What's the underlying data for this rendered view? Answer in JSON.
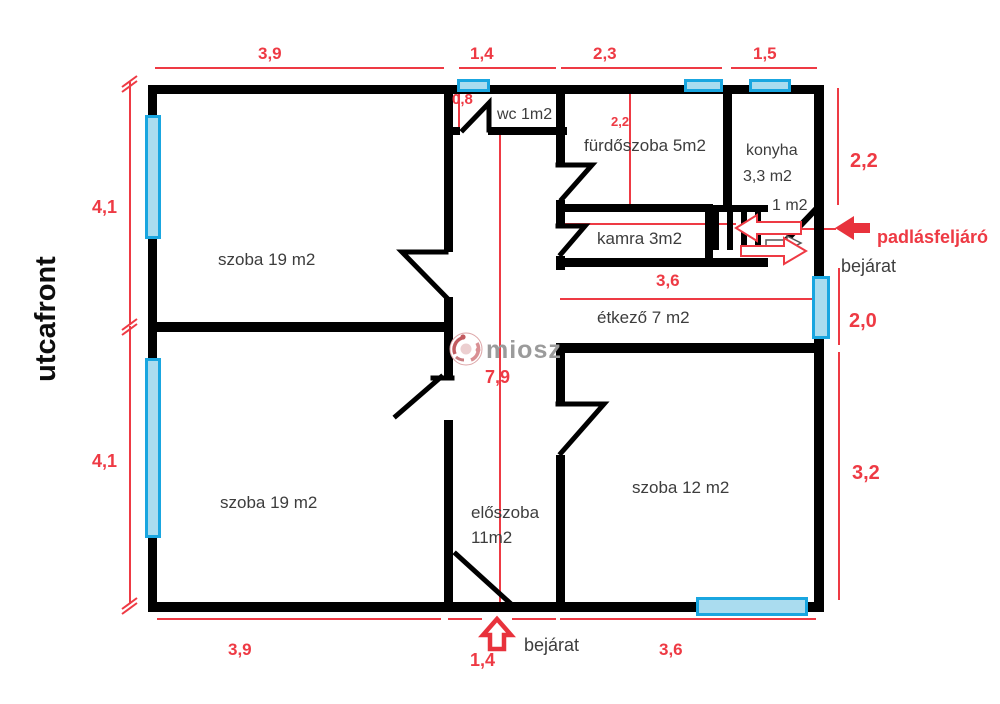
{
  "plan": {
    "street_label": "utcafront",
    "watermark": "miosz",
    "rooms": {
      "szoba_top": "szoba 19 m2",
      "szoba_bottom": "szoba 19 m2",
      "wc": "wc 1m2",
      "furdoszoba": "fürdőszoba 5m2",
      "konyha_name": "konyha",
      "konyha_area": "3,3 m2",
      "attic_space_area": "1 m2",
      "kamra": "kamra 3m2",
      "etkezo": "étkező 7 m2",
      "szoba_12": "szoba 12 m2",
      "eloszoba_name": "előszoba",
      "eloszoba_area": "11m2"
    },
    "dims": {
      "top_szoba_width": "3,9",
      "top_wc_width": "1,4",
      "top_furdoszoba_width": "2,3",
      "top_konyha_width": "1,5",
      "left_upper": "4,1",
      "left_lower": "4,1",
      "right_konyha_height": "2,2",
      "right_entrance_height": "2,0",
      "right_szoba12_height": "3,2",
      "bottom_szoba_width": "3,9",
      "bottom_entrance_width": "1,4",
      "bottom_szoba12_width": "3,6",
      "wc_window_width": "0,8",
      "furdoszoba_depth": "2,2",
      "hall_length": "7,9",
      "etkezo_width": "3,6"
    },
    "labels": {
      "attic_access": "padlásfeljáró",
      "entrance_side": "bejárat",
      "entrance_bottom": "bejárat"
    },
    "colors": {
      "wall": "#000000",
      "dimension_red": "#ee3a44",
      "window_border": "#19a6e0",
      "window_fill": "#aadcef",
      "room_text": "#3d3d3d"
    }
  }
}
